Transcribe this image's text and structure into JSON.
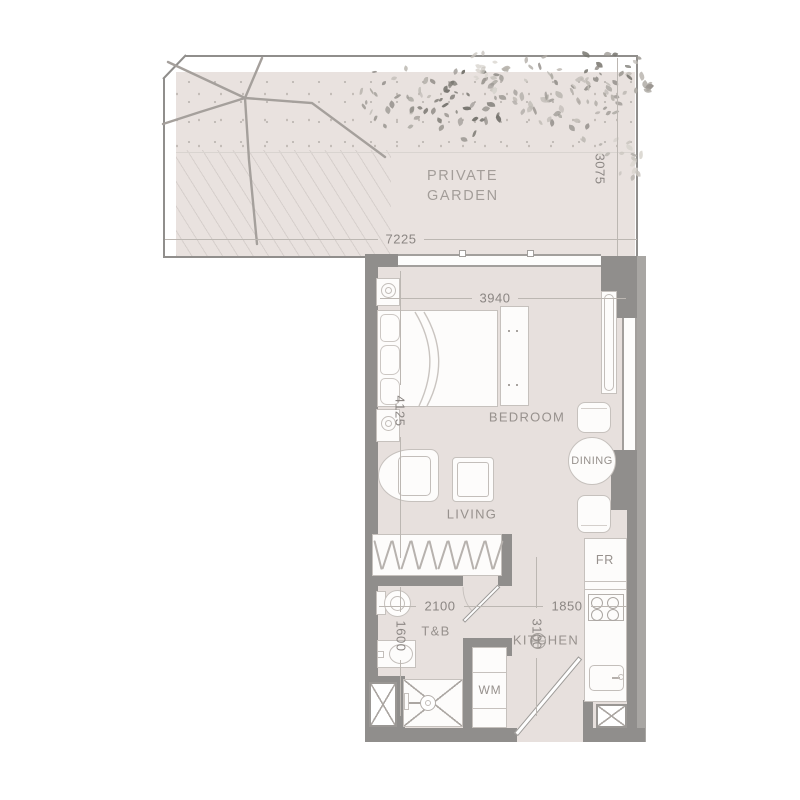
{
  "garden": {
    "label_line1": "PRIVATE",
    "label_line2": "GARDEN",
    "width_dim": "7225",
    "depth_dim": "3075",
    "foliage": {
      "palettes": {
        "dark": [
          "#77756f",
          "#8a8781",
          "#9b9792"
        ],
        "mid": [
          "#9b9792",
          "#aeaaa4",
          "#bfbbb5"
        ],
        "light": [
          "#b8b4ae",
          "#c9c5bf",
          "#d8d4ce"
        ]
      },
      "clusters": [
        {
          "x": 395,
          "y": 95,
          "r": 42,
          "n": 26,
          "tone": "mid"
        },
        {
          "x": 455,
          "y": 100,
          "r": 48,
          "n": 36,
          "tone": "dark"
        },
        {
          "x": 520,
          "y": 80,
          "r": 40,
          "n": 24,
          "tone": "mid"
        },
        {
          "x": 575,
          "y": 105,
          "r": 45,
          "n": 28,
          "tone": "mid"
        },
        {
          "x": 620,
          "y": 85,
          "r": 38,
          "n": 26,
          "tone": "mid"
        },
        {
          "x": 628,
          "y": 150,
          "r": 32,
          "n": 18,
          "tone": "light"
        },
        {
          "x": 500,
          "y": 62,
          "r": 35,
          "n": 16,
          "tone": "light"
        },
        {
          "x": 608,
          "y": 58,
          "r": 30,
          "n": 16,
          "tone": "dark"
        }
      ]
    }
  },
  "rooms": {
    "bedroom": {
      "label": "BEDROOM",
      "width_dim": "3940",
      "height_dim": "4125"
    },
    "living": {
      "label": "LIVING"
    },
    "dining": {
      "label": "DINING"
    },
    "bath": {
      "label": "T&B",
      "width_dim": "2100",
      "height_dim": "1600"
    },
    "kitchen": {
      "label": "KITCHEN",
      "width_dim": "1850",
      "height_dim": "3100"
    }
  },
  "appliances": {
    "washing_machine_label": "WM",
    "fridge_label": "FR"
  },
  "closet": {
    "hanger_count": 14
  },
  "colors": {
    "garden_floor": "#e9e2df",
    "unit_floor": "#e7e0dd",
    "wall": "#908e8c",
    "wall_light": "#a8a6a3",
    "furniture_line": "#c6c1bd",
    "dim_line": "#bcb7b2",
    "label_text": "#97918d",
    "dim_text": "#8b8683"
  }
}
